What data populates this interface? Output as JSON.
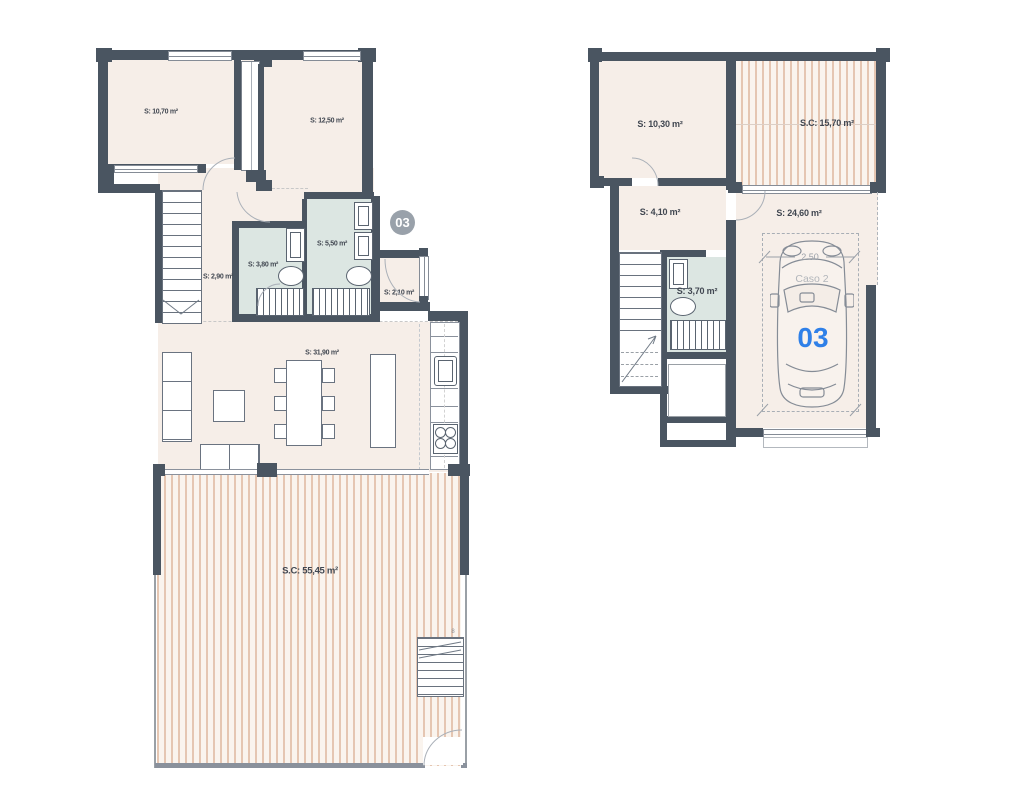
{
  "colors": {
    "wall": "#4a5561",
    "room-fill": "#f6eee8",
    "bath-fill": "#dce6e2",
    "terrace-stripe": "#e5c6b2",
    "terrace-bg": "#faf4ee",
    "badge-bg": "#99a1aa",
    "unit-blue": "#2f80e8",
    "label-text": "#414751",
    "dim-gray": "#9aa0a8",
    "caso-gray": "#b2b6bb"
  },
  "floor1": {
    "badge": "03",
    "rooms": {
      "bedroom1": {
        "label": "S: 10,70 m²"
      },
      "bedroom2": {
        "label": "S: 12,50 m²"
      },
      "stair_hall": {
        "label": "S: 2,90 m²"
      },
      "bath1": {
        "label": "S: 3,80 m²"
      },
      "bath2": {
        "label": "S: 5,50 m²"
      },
      "entry": {
        "label": "S: 2,10 m²"
      },
      "living_kitchen": {
        "label": "S: 31,90 m²"
      },
      "terrace": {
        "label": "S.C: 55,45 m²"
      }
    },
    "terrace_stair_steps": "8"
  },
  "floor2": {
    "rooms": {
      "bedroom": {
        "label": "S: 10,30 m²"
      },
      "solarium": {
        "label": "S.C: 15,70 m²"
      },
      "hall": {
        "label": "S: 4,10 m²"
      },
      "garage": {
        "label": "S: 24,60 m²"
      },
      "bath": {
        "label": "S: 3,70 m²"
      }
    },
    "garage_annotations": {
      "width_dimension": "2.50",
      "case_label": "Caso 2",
      "unit_number": "03"
    }
  }
}
